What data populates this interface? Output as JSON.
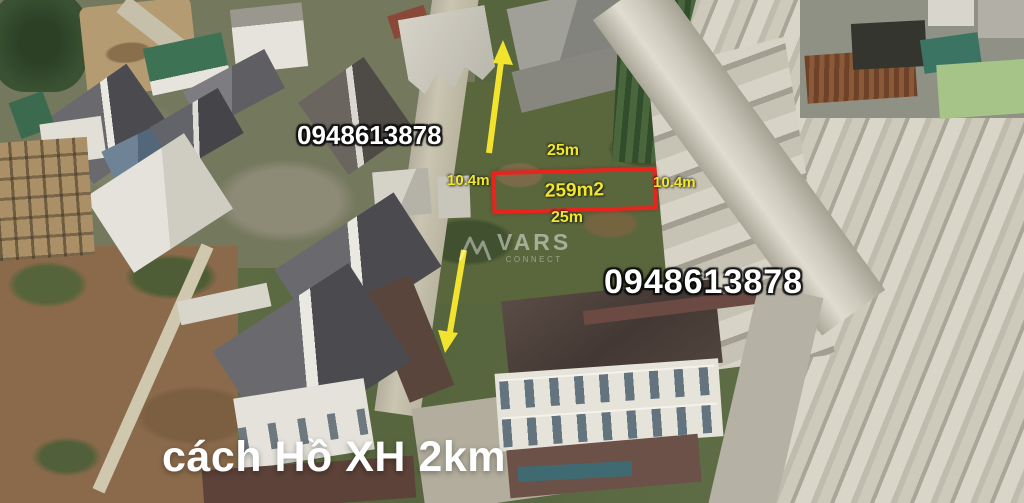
{
  "annotations": {
    "phone_number_top": "0948613878",
    "phone_number_bottom": "0948613878",
    "caption": "cách Hồ XH 2km",
    "watermark": {
      "brand": "VARS",
      "subtitle": "CONNECT"
    },
    "plot_overlay": {
      "area": "259m2",
      "top_length": "25m",
      "bottom_length": "25m",
      "left_width": "10.4m",
      "right_width": "10.4m"
    },
    "colors": {
      "plot_outline": "#e8241e",
      "dimension_text": "#f0e62a",
      "arrow": "#f2e42e",
      "phone_text": "#ffffff",
      "caption_text": "#ffffff"
    }
  }
}
